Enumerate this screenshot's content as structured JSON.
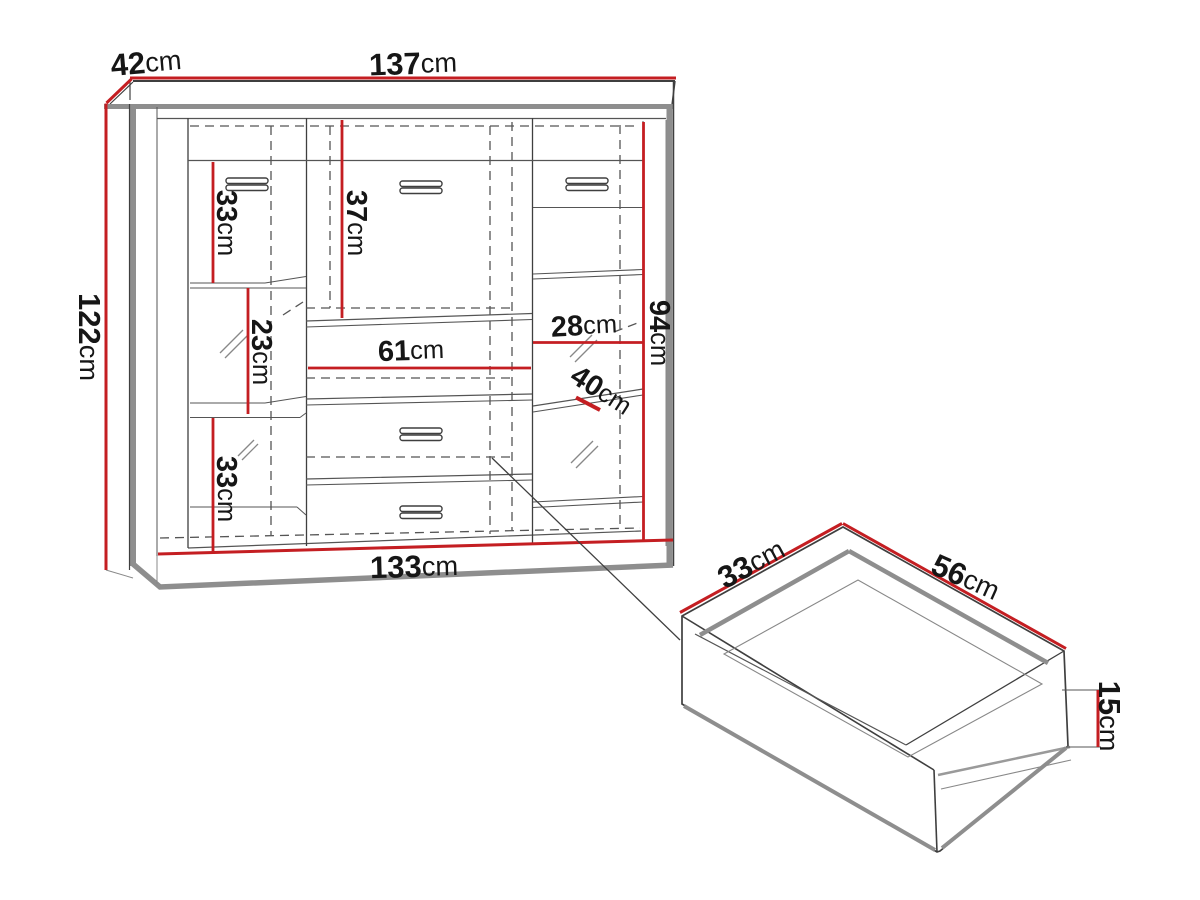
{
  "colors": {
    "dimension_line": "#c41e22",
    "drawing_line": "#3f3f3f",
    "panel_shadow": "#8e8e8e",
    "text": "#161616",
    "background": "#ffffff"
  },
  "dims": {
    "cabinet": {
      "depth": {
        "value": "42",
        "unit": "cm"
      },
      "width_top": {
        "value": "137",
        "unit": "cm"
      },
      "height": {
        "value": "122",
        "unit": "cm"
      },
      "width_bottom": {
        "value": "133",
        "unit": "cm"
      },
      "left_top_section": {
        "value": "33",
        "unit": "cm"
      },
      "left_middle_section": {
        "value": "23",
        "unit": "cm"
      },
      "left_bottom_section": {
        "value": "33",
        "unit": "cm"
      },
      "middle_flap_height": {
        "value": "37",
        "unit": "cm"
      },
      "middle_width": {
        "value": "61",
        "unit": "cm"
      },
      "right_section_width": {
        "value": "28",
        "unit": "cm"
      },
      "right_shelf_depth": {
        "value": "40",
        "unit": "cm"
      },
      "interior_height": {
        "value": "94",
        "unit": "cm"
      }
    },
    "drawer": {
      "depth": {
        "value": "33",
        "unit": "cm"
      },
      "width": {
        "value": "56",
        "unit": "cm"
      },
      "height": {
        "value": "15",
        "unit": "cm"
      }
    }
  }
}
